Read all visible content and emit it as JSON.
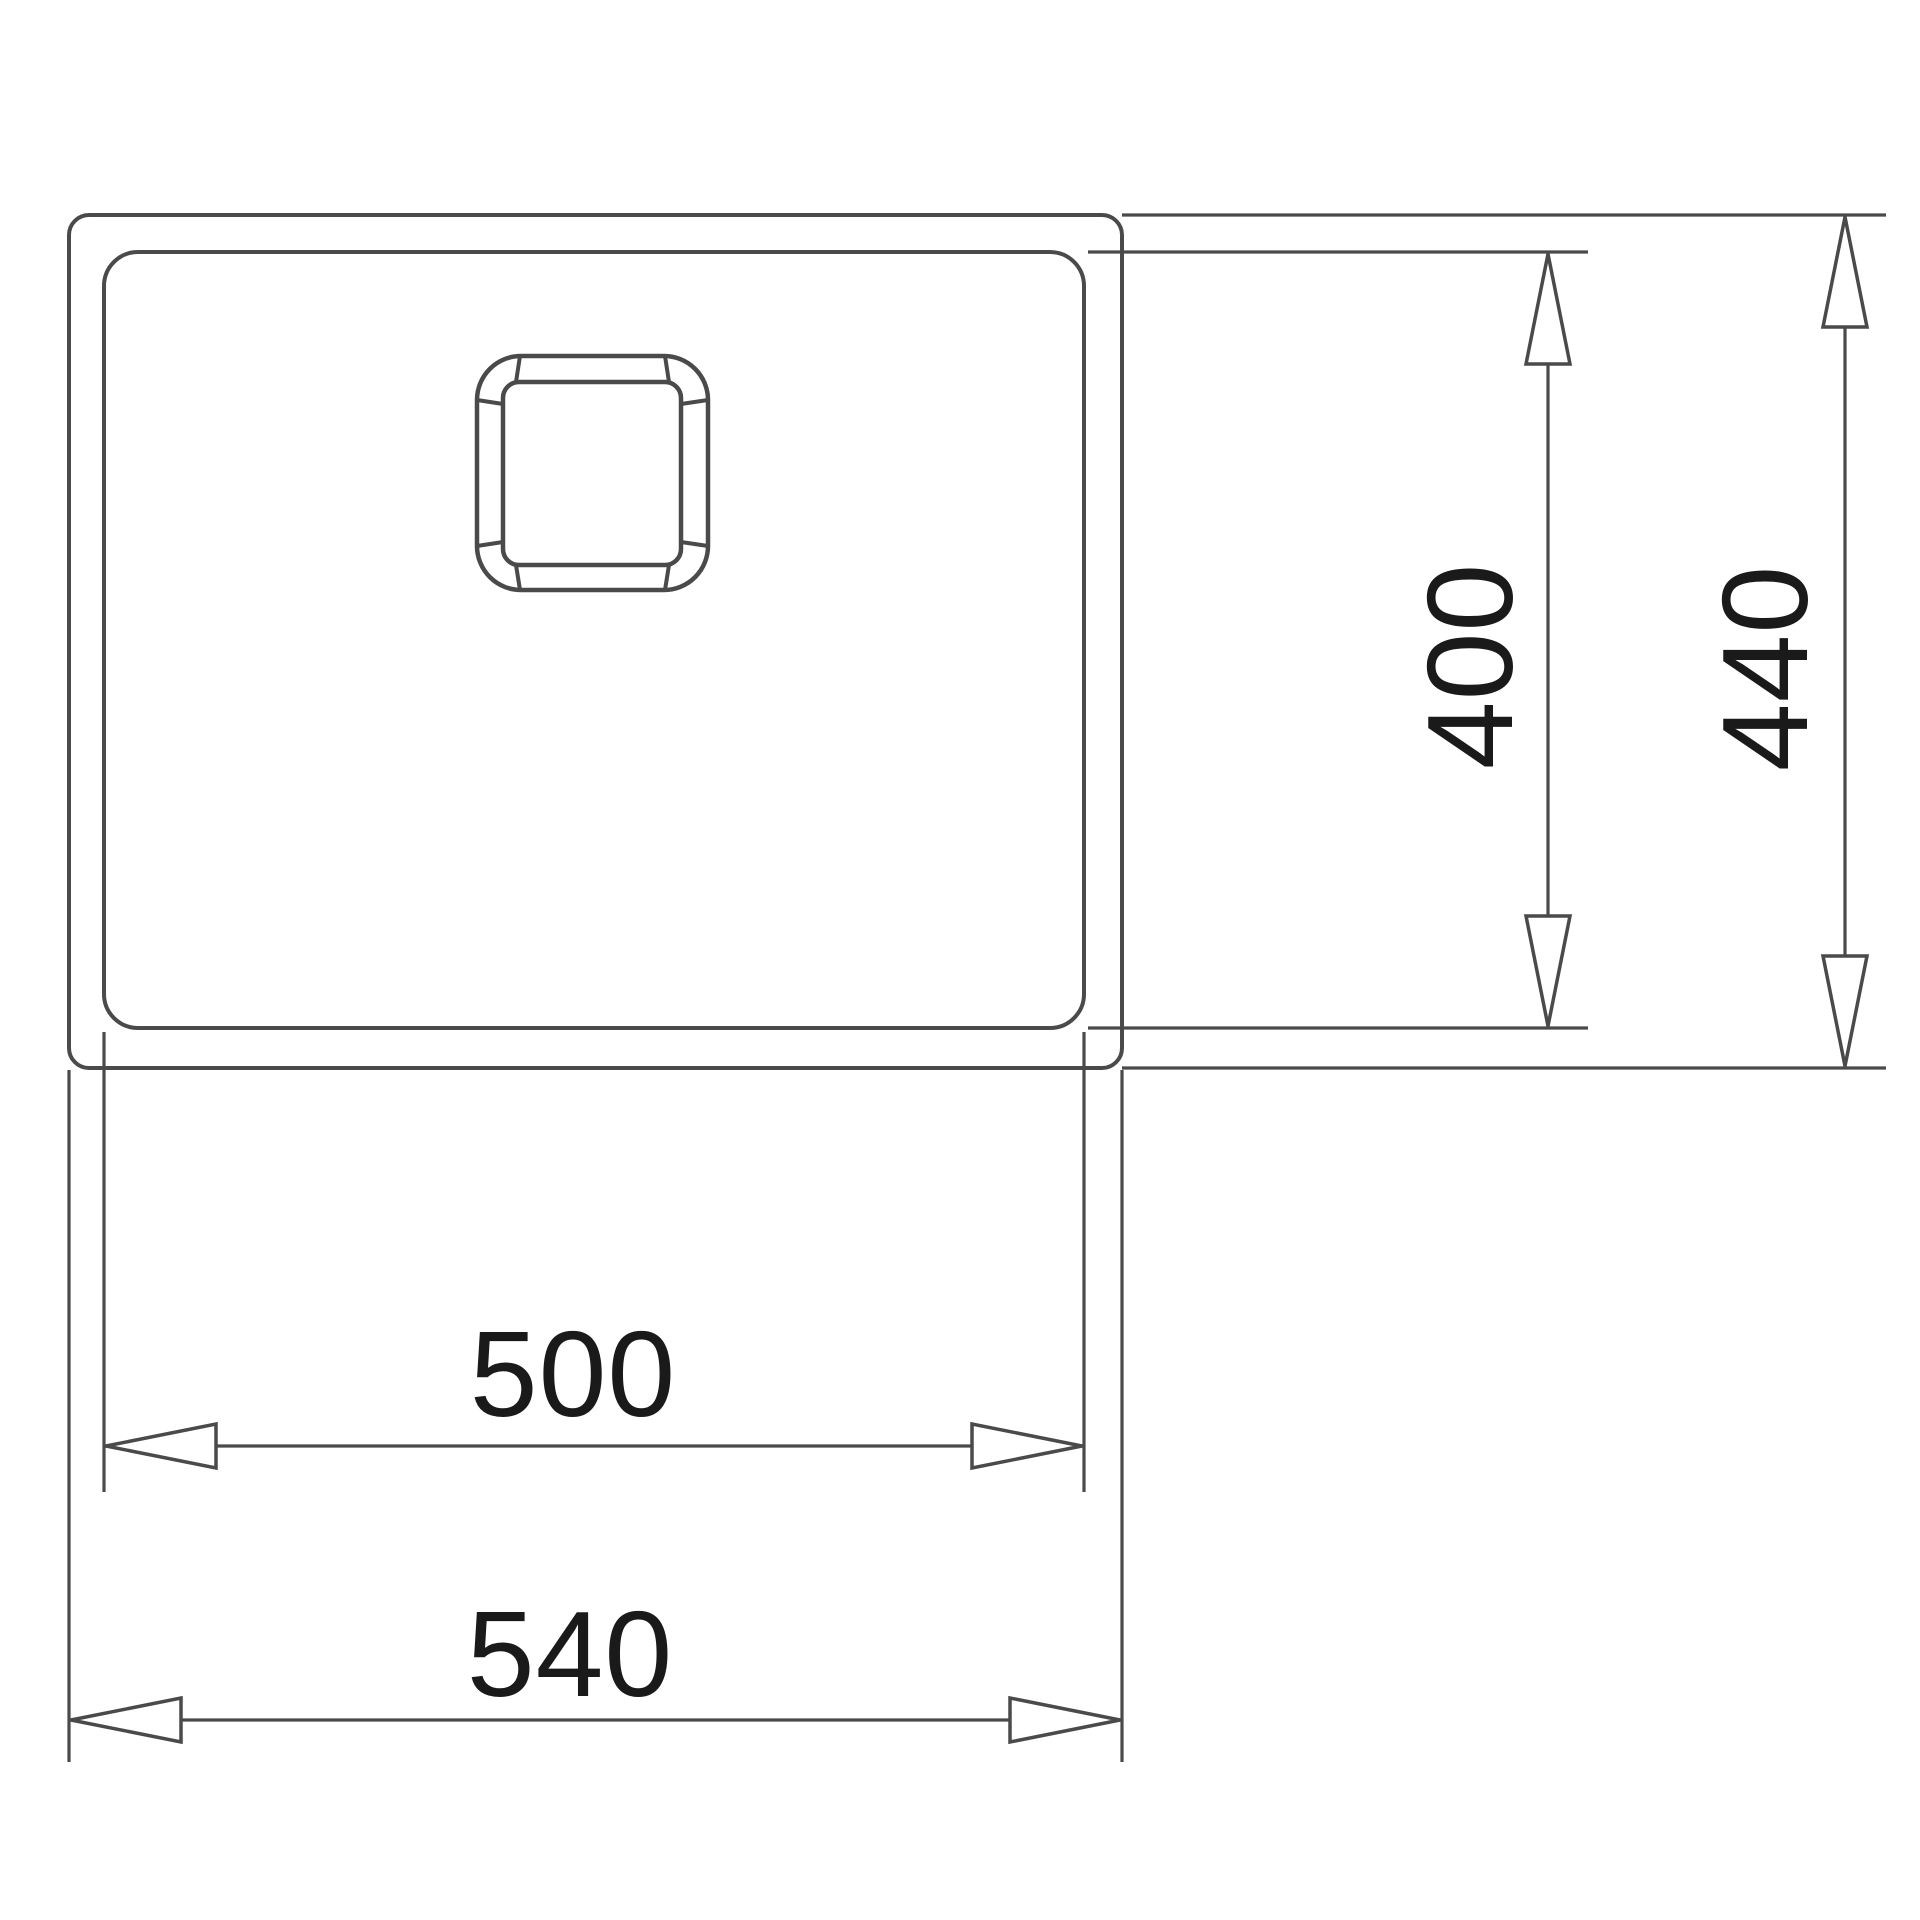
{
  "drawing": {
    "kind": "sink-cutout-dimension-diagram",
    "view": "top-view",
    "units": "mm",
    "colors": {
      "background": "#ffffff",
      "line": "#4a4a4a",
      "text": "#1a1a1a",
      "arrow_fill": "#ffffff"
    },
    "dimensions": {
      "inner_width": {
        "label": "500",
        "orientation": "horizontal",
        "measures": "bowl width"
      },
      "outer_width": {
        "label": "540",
        "orientation": "horizontal",
        "measures": "overall width"
      },
      "inner_depth": {
        "label": "400",
        "orientation": "vertical",
        "measures": "bowl depth"
      },
      "outer_depth": {
        "label": "440",
        "orientation": "vertical",
        "measures": "overall depth"
      }
    }
  }
}
